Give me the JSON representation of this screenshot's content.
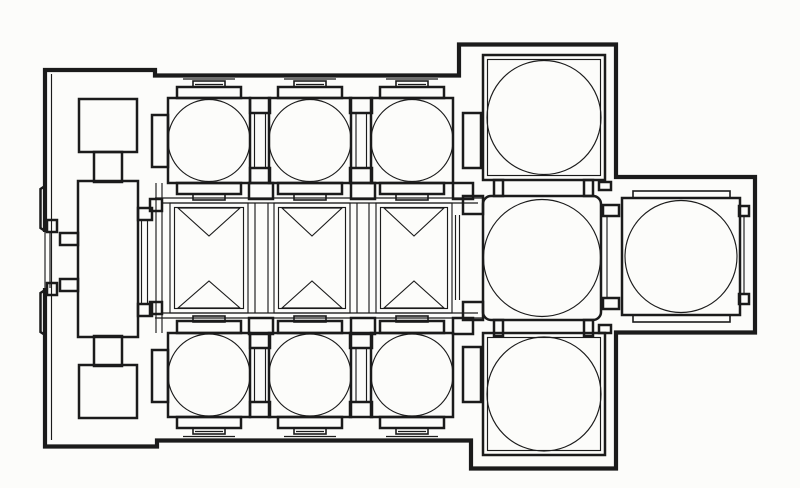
{
  "canvas": {
    "width": 800,
    "height": 488,
    "paper": "#fcfcfa",
    "ink": "#1b1b1b"
  },
  "plan": {
    "kind": "church-floor-plan-line-drawing",
    "paths": [
      {
        "name": "outer-wall-outline",
        "cls": "w4",
        "d": "M 45 232 L 45 70 L 155 70 L 155 75.5 L 459 75.5 L 459 44.5 L 616 44.5 L 616 177 L 755 177 L 755 332.5 L 616 332.5 L 616 468.5 L 471 468.5 L 471 440.5 L 157 440.5 L 157 446.5 L 45 446.5 L 45 288"
      },
      {
        "name": "west-wall-pilaster-bump",
        "cls": "w2",
        "d": "M 45 186 L 40.5 189 L 40.5 228 L 45 231"
      },
      {
        "name": "west-wall-pilaster-bump",
        "cls": "w2",
        "d": "M 45 290 L 40.5 293 L 40.5 332 L 45 335"
      }
    ],
    "rects": [
      [
        79,
        99,
        58,
        53,
        "w2",
        0,
        "narthex-north-pier"
      ],
      [
        94,
        152,
        28,
        30,
        "w2",
        0,
        "narthex-north-stem"
      ],
      [
        78,
        181,
        60,
        156,
        "w2",
        0,
        "narthex-central-room"
      ],
      [
        94,
        336,
        28,
        30,
        "w2",
        0,
        "narthex-south-stem"
      ],
      [
        79,
        365,
        58,
        53,
        "w2",
        0,
        "narthex-south-pier"
      ],
      [
        138,
        208,
        14,
        12,
        "w2",
        0,
        "narthex-east-door-jamb"
      ],
      [
        138,
        304,
        14,
        12,
        "w2",
        0,
        "narthex-east-door-jamb"
      ],
      [
        60,
        233,
        18,
        12,
        "w2",
        0,
        "narthex-vestibule-stub"
      ],
      [
        60,
        279,
        18,
        12,
        "w2",
        0,
        "narthex-vestibule-stub"
      ],
      [
        150,
        199,
        12,
        12,
        "w2",
        0,
        "nave-west-door-jamb"
      ],
      [
        150,
        302,
        12,
        12,
        "w2",
        0,
        "nave-west-door-jamb"
      ],
      [
        47,
        220,
        10,
        12,
        "w2",
        0,
        "west-door-jamb"
      ],
      [
        47,
        283,
        10,
        12,
        "w2",
        0,
        "west-door-jamb"
      ],
      [
        152,
        115,
        16,
        52,
        "w2",
        0,
        "north-aisle-west-pier"
      ],
      [
        152,
        350,
        16,
        52,
        "w2",
        0,
        "south-aisle-west-pier"
      ],
      [
        250,
        98,
        20,
        15,
        "w2",
        0,
        "north-aisle-bay-stub"
      ],
      [
        250,
        168,
        20,
        15,
        "w2",
        0,
        "north-aisle-bay-stub"
      ],
      [
        350,
        98,
        22,
        15,
        "w2",
        0,
        "north-aisle-bay-stub"
      ],
      [
        350,
        168,
        22,
        15,
        "w2",
        0,
        "north-aisle-bay-stub"
      ],
      [
        250,
        333,
        20,
        15,
        "w2",
        0,
        "south-aisle-bay-stub"
      ],
      [
        250,
        402,
        20,
        15,
        "w2",
        0,
        "south-aisle-bay-stub"
      ],
      [
        350,
        333,
        22,
        15,
        "w2",
        0,
        "south-aisle-bay-stub"
      ],
      [
        350,
        402,
        22,
        15,
        "w2",
        0,
        "south-aisle-bay-stub"
      ],
      [
        463,
        113,
        18,
        55,
        "w2",
        0,
        "north-aisle-east-pier"
      ],
      [
        463,
        347,
        18,
        55,
        "w2",
        0,
        "south-aisle-east-pier"
      ],
      [
        168,
        98,
        82,
        85,
        "w2",
        0,
        "north-aisle-bay-square"
      ],
      [
        269,
        98,
        82,
        85,
        "w2",
        0,
        "north-aisle-bay-square"
      ],
      [
        371,
        98,
        82,
        85,
        "w2",
        0,
        "north-aisle-bay-square"
      ],
      [
        168,
        333,
        82,
        84,
        "w2",
        0,
        "south-aisle-bay-square"
      ],
      [
        269,
        333,
        82,
        84,
        "w2",
        0,
        "south-aisle-bay-square"
      ],
      [
        371,
        333,
        82,
        84,
        "w2",
        0,
        "south-aisle-bay-square"
      ],
      [
        177,
        87,
        64,
        11,
        "w2",
        0,
        "bay-crown-step"
      ],
      [
        278,
        87,
        64,
        11,
        "w2",
        0,
        "bay-crown-step"
      ],
      [
        380,
        87,
        64,
        11,
        "w2",
        0,
        "bay-crown-step"
      ],
      [
        177,
        183,
        64,
        11,
        "w2",
        0,
        "bay-crown-step"
      ],
      [
        278,
        183,
        64,
        11,
        "w2",
        0,
        "bay-crown-step"
      ],
      [
        380,
        183,
        64,
        11,
        "w2",
        0,
        "bay-crown-step"
      ],
      [
        177,
        321,
        64,
        12,
        "w2",
        0,
        "bay-crown-step"
      ],
      [
        278,
        321,
        64,
        12,
        "w2",
        0,
        "bay-crown-step"
      ],
      [
        380,
        321,
        64,
        12,
        "w2",
        0,
        "bay-crown-step"
      ],
      [
        177,
        417,
        64,
        11,
        "w2",
        0,
        "bay-crown-step"
      ],
      [
        278,
        417,
        64,
        11,
        "w2",
        0,
        "bay-crown-step"
      ],
      [
        380,
        417,
        64,
        11,
        "w2",
        0,
        "bay-crown-step"
      ],
      [
        193,
        81,
        32,
        6,
        "w15",
        0,
        "pilaster-capital"
      ],
      [
        294,
        81,
        32,
        6,
        "w15",
        0,
        "pilaster-capital"
      ],
      [
        396,
        81,
        32,
        6,
        "w15",
        0,
        "pilaster-capital"
      ],
      [
        193,
        194,
        32,
        6,
        "w15",
        0,
        "pilaster-capital"
      ],
      [
        294,
        194,
        32,
        6,
        "w15",
        0,
        "pilaster-capital"
      ],
      [
        396,
        194,
        32,
        6,
        "w15",
        0,
        "pilaster-capital"
      ],
      [
        193,
        316,
        32,
        6,
        "w15",
        0,
        "pilaster-capital"
      ],
      [
        294,
        316,
        32,
        6,
        "w15",
        0,
        "pilaster-capital"
      ],
      [
        396,
        316,
        32,
        6,
        "w15",
        0,
        "pilaster-capital"
      ],
      [
        193,
        428,
        32,
        6,
        "w15",
        0,
        "pilaster-capital"
      ],
      [
        294,
        428,
        32,
        6,
        "w15",
        0,
        "pilaster-capital"
      ],
      [
        396,
        428,
        32,
        6,
        "w15",
        0,
        "pilaster-capital"
      ],
      [
        249,
        183,
        24,
        16,
        "w2",
        0,
        "nave-arcade-pier"
      ],
      [
        249,
        318,
        24,
        16,
        "w2",
        0,
        "nave-arcade-pier"
      ],
      [
        351,
        183,
        24,
        16,
        "w2",
        0,
        "nave-arcade-pier"
      ],
      [
        351,
        318,
        24,
        16,
        "w2",
        0,
        "nave-arcade-pier"
      ],
      [
        453,
        183,
        20,
        16,
        "w2",
        0,
        "nave-arcade-pier"
      ],
      [
        453,
        318,
        20,
        16,
        "w2",
        0,
        "nave-arcade-pier"
      ],
      [
        494,
        180,
        9,
        16,
        "w2",
        0,
        "crossing-north-jamb"
      ],
      [
        584,
        180,
        9,
        16,
        "w2",
        0,
        "crossing-north-jamb"
      ],
      [
        494,
        320,
        9,
        16,
        "w2",
        0,
        "crossing-south-jamb"
      ],
      [
        584,
        320,
        9,
        16,
        "w2",
        0,
        "crossing-south-jamb"
      ],
      [
        463,
        196,
        20,
        18,
        "w2",
        0,
        "crossing-west-jamb"
      ],
      [
        463,
        302,
        20,
        18,
        "w2",
        0,
        "crossing-west-jamb"
      ],
      [
        599,
        182,
        12,
        8,
        "w2",
        0,
        "crossing-east-stub"
      ],
      [
        599,
        325,
        12,
        8,
        "w2",
        0,
        "crossing-east-stub"
      ],
      [
        603,
        205,
        16,
        11,
        "w2",
        0,
        "bema-door-jamb"
      ],
      [
        603,
        298,
        16,
        11,
        "w2",
        0,
        "bema-door-jamb"
      ],
      [
        483,
        196,
        118,
        124,
        "w2",
        8,
        "crossing-square"
      ],
      [
        483,
        55,
        122,
        125,
        "w2",
        0,
        "northeast-chamber-square"
      ],
      [
        483,
        333,
        122,
        122,
        "w2",
        0,
        "southeast-chamber-square"
      ],
      [
        622,
        198,
        118,
        117,
        "w2",
        0,
        "bema-square"
      ],
      [
        633,
        191,
        97,
        7,
        "w15",
        0,
        "bema-step"
      ],
      [
        633,
        315,
        97,
        7,
        "w15",
        0,
        "bema-step"
      ],
      [
        739,
        206,
        10,
        10,
        "w2",
        0,
        "apse-niche-notch"
      ],
      [
        739,
        294,
        10,
        10,
        "w2",
        0,
        "apse-niche-notch"
      ],
      [
        487.5,
        59.5,
        113,
        116,
        "w1",
        0,
        "chamber-inner-line"
      ],
      [
        487.5,
        337.5,
        113,
        113,
        "w1",
        0,
        "chamber-inner-line"
      ],
      [
        170,
        203,
        78,
        110,
        "w1",
        0,
        "nave-bay-frame"
      ],
      [
        274,
        203,
        76,
        110,
        "w1",
        0,
        "nave-bay-frame"
      ],
      [
        376,
        203,
        76,
        110,
        "w1",
        0,
        "nave-bay-frame"
      ],
      [
        174.5,
        207.5,
        69,
        101,
        "w1",
        0,
        "nave-bay-inner-frame"
      ],
      [
        278.5,
        207.5,
        67,
        101,
        "w1",
        0,
        "nave-bay-inner-frame"
      ],
      [
        380.5,
        207.5,
        67,
        101,
        "w1",
        0,
        "nave-bay-inner-frame"
      ]
    ],
    "circles": [
      [
        209,
        140.5,
        41,
        "north-aisle-dome"
      ],
      [
        310,
        140.5,
        41,
        "north-aisle-dome"
      ],
      [
        412,
        140.5,
        41,
        "north-aisle-dome"
      ],
      [
        209,
        375,
        41,
        "south-aisle-dome"
      ],
      [
        310,
        375,
        41,
        "south-aisle-dome"
      ],
      [
        412,
        375,
        41,
        "south-aisle-dome"
      ],
      [
        542,
        258,
        58.5,
        "crossing-dome"
      ],
      [
        544,
        117.5,
        57,
        "northeast-chamber-dome"
      ],
      [
        544,
        394,
        57,
        "southeast-chamber-dome"
      ],
      [
        681,
        256.5,
        56,
        "bema-dome"
      ]
    ],
    "lines": [
      [
        51.5,
        74,
        51.5,
        440,
        "west-wall-inner-face"
      ],
      [
        45,
        232,
        45,
        288,
        "west-door-threshold"
      ],
      [
        50,
        232,
        50,
        288,
        "west-door-threshold"
      ],
      [
        141.5,
        220,
        141.5,
        304,
        "narthex-east-door-line"
      ],
      [
        147.5,
        220,
        147.5,
        304,
        "narthex-east-door-line"
      ],
      [
        254.5,
        113,
        254.5,
        168,
        "aisle-opening-line"
      ],
      [
        265.5,
        113,
        265.5,
        168,
        "aisle-opening-line"
      ],
      [
        356,
        113,
        356,
        168,
        "aisle-opening-line"
      ],
      [
        366.5,
        113,
        366.5,
        168,
        "aisle-opening-line"
      ],
      [
        254.5,
        348,
        254.5,
        402,
        "aisle-opening-line"
      ],
      [
        265.5,
        348,
        265.5,
        402,
        "aisle-opening-line"
      ],
      [
        356,
        348,
        356,
        402,
        "aisle-opening-line"
      ],
      [
        366.5,
        348,
        366.5,
        402,
        "aisle-opening-line"
      ],
      [
        155,
        198,
        483,
        198,
        "nave-north-wall-line"
      ],
      [
        162,
        203,
        478,
        203,
        "nave-north-wall-line"
      ],
      [
        162,
        313,
        478,
        313,
        "nave-south-wall-line"
      ],
      [
        155,
        318,
        483,
        318,
        "nave-south-wall-line"
      ],
      [
        156,
        183,
        156,
        333,
        "nave-west-wall-line"
      ],
      [
        162,
        183,
        162,
        333,
        "nave-west-wall-line"
      ],
      [
        255,
        203,
        255,
        313,
        "nave-pilaster-strip"
      ],
      [
        268,
        203,
        268,
        313,
        "nave-pilaster-strip"
      ],
      [
        357,
        203,
        357,
        313,
        "nave-pilaster-strip"
      ],
      [
        369,
        203,
        369,
        313,
        "nave-pilaster-strip"
      ],
      [
        455.5,
        215,
        455.5,
        300,
        "nave-east-arch-line"
      ],
      [
        459.5,
        215,
        459.5,
        300,
        "nave-east-arch-line"
      ],
      [
        607,
        216,
        607,
        298,
        "crossing-bema-opening-line"
      ],
      [
        744,
        216,
        744,
        294,
        "apse-niche-line"
      ],
      [
        183,
        79,
        235,
        79,
        "pilaster-slab"
      ],
      [
        284,
        79,
        336,
        79,
        "pilaster-slab"
      ],
      [
        386,
        79,
        438,
        79,
        "pilaster-slab"
      ],
      [
        183,
        436.5,
        235,
        436.5,
        "pilaster-slab"
      ],
      [
        284,
        436.5,
        336,
        436.5,
        "pilaster-slab"
      ],
      [
        386,
        436.5,
        438,
        436.5,
        "pilaster-slab"
      ],
      [
        195,
        84.5,
        223,
        84.5,
        "pilaster-detail"
      ],
      [
        296,
        84.5,
        324,
        84.5,
        "pilaster-detail"
      ],
      [
        398,
        84.5,
        426,
        84.5,
        "pilaster-detail"
      ],
      [
        195,
        431.5,
        223,
        431.5,
        "pilaster-detail"
      ],
      [
        296,
        431.5,
        324,
        431.5,
        "pilaster-detail"
      ],
      [
        398,
        431.5,
        426,
        431.5,
        "pilaster-detail"
      ]
    ],
    "polygons": [
      [
        "178,208 240,208 209,236",
        "nave-vault-triangle"
      ],
      [
        "178,308 240,308 209,281",
        "nave-vault-triangle"
      ],
      [
        "282,208 342,208 312,236",
        "nave-vault-triangle"
      ],
      [
        "282,308 342,308 312,281",
        "nave-vault-triangle"
      ],
      [
        "384,208 444,208 414,236",
        "nave-vault-triangle"
      ],
      [
        "384,308 444,308 414,281",
        "nave-vault-triangle"
      ]
    ]
  }
}
